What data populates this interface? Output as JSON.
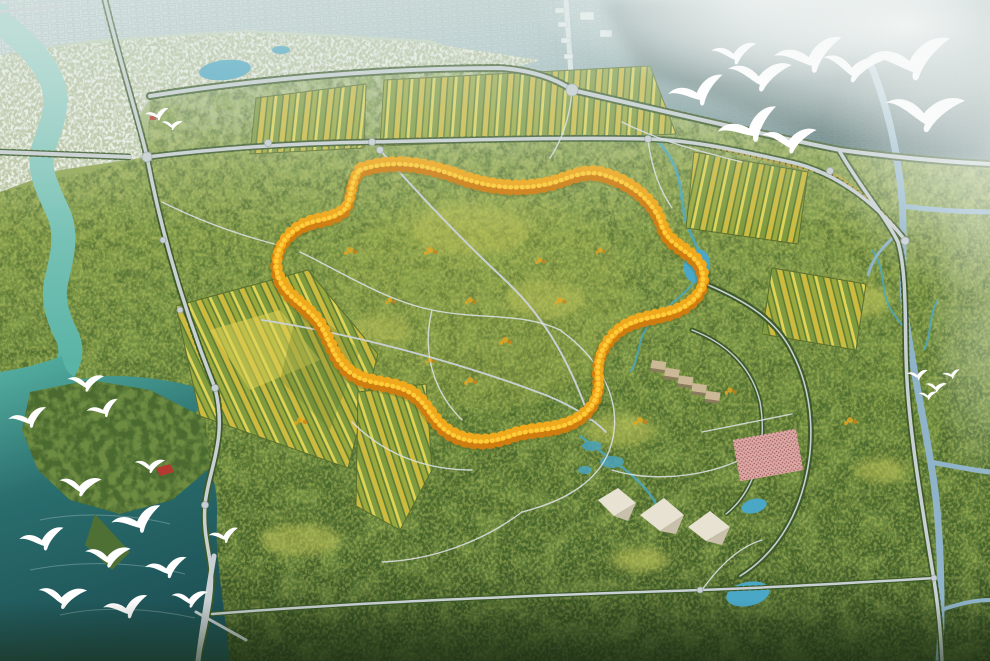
{
  "meta": {
    "title": "Forest park master plan — aerial rendering",
    "description": "Bird's-eye architectural rendering of a large forest park: a golden ring of autumn trees loops through green woodland, orchard grids line the north and west, a turquoise river and lake with flying white egrets border the west, white tent pavilions and a pink event plaza sit in the southeast, a canal and tree-lined avenues cross the east, and a hazy city skyline fades into fog along the northern horizon.",
    "type": "architectural-aerial-rendering"
  },
  "palette": {
    "haze_top": "#d7e4df",
    "city": "#b6cbd0",
    "city_light": "#d3e0e1",
    "city_dark": "#5f7f81",
    "city_shade": "#2c4a47",
    "city_lines": "#8fa6a8",
    "avenue_pale": "#e2eaec",
    "building_white": "#eef3f4",
    "fog": "#f6f9f8",
    "forest_top": "#93a855",
    "forest_mid": "#5e7c36",
    "forest_deep": "#3a5526",
    "forest_blotch_dark": "#41602c",
    "forest_blotch_light": "#7d9a49",
    "forest_speckle": "#bcca65",
    "wetland_pale": "#b9c4a0",
    "meadow": "#c6c95c",
    "river_light": "#a8d8d0",
    "river": "#57b3a4",
    "lake_deep": "#2a6e6e",
    "lake_darkest": "#1d5156",
    "pond": "#4aa7c6",
    "canal": "#8fb3c9",
    "road": "#c9d0d4",
    "road_minor": "#dadfe2",
    "treeline": "#3d5a28",
    "treeline_gold": "#c9a83c",
    "loop_shadow": "#5a6b26",
    "loop_orange_dark": "#cf7d10",
    "loop_orange": "#f0a81c",
    "loop_yellow": "#ffd23e",
    "field_green": "#7f9a3f",
    "field_yellow": "#cdbb3f",
    "field_dark": "#5d7c33",
    "field_olive": "#9aa93e",
    "field_pale": "#e0d455",
    "bird_white": "#ffffff",
    "plaza_pink": "#dba8a4",
    "plaza_dots": "#8c3f46",
    "tent_white": "#e8e2d2",
    "tent_shade": "#c9c0ab",
    "pavilion_tan": "#cbb896",
    "pavilion_dark": "#8a7a5e",
    "roof_red": "#b43a30",
    "vignette": "#1c2e14"
  },
  "scene": {
    "city": {
      "label": "hazy city skyline along northern horizon"
    },
    "fog": {
      "label": "fog bank",
      "position": "top-right"
    },
    "river": {
      "label": "turquoise river"
    },
    "lake": {
      "label": "lake with wooded island"
    },
    "golden_loop": {
      "label": "golden autumn-tree loop trail"
    },
    "orchards": {
      "label": "orchard field grids",
      "count": 6
    },
    "east_ring": {
      "label": "tree-lined ring avenue",
      "position": "southeast"
    },
    "structures": {
      "pavilion_row": {
        "label": "row of hillside pavilions",
        "count": 5
      },
      "tents": {
        "label": "white canopy pavilions",
        "count": 3
      },
      "event_plaza": {
        "label": "pink event plaza filled with visitors"
      },
      "island_hut": {
        "label": "red-roofed hut on lake island"
      },
      "north_hut": {
        "label": "red-roofed kiosk by north pond"
      }
    },
    "birds": {
      "label": "white egrets in flight",
      "top_right_flock": 9,
      "lake_flock": 13,
      "distant_specks": 4,
      "north_pair": 2
    },
    "waterworks": {
      "ponds": 5,
      "canal": "eastern canal",
      "streams": "wetland streams"
    },
    "roads": {
      "label": "tree-lined park roads",
      "bridges": 2,
      "causeway": 1,
      "roundabouts": 14
    }
  }
}
